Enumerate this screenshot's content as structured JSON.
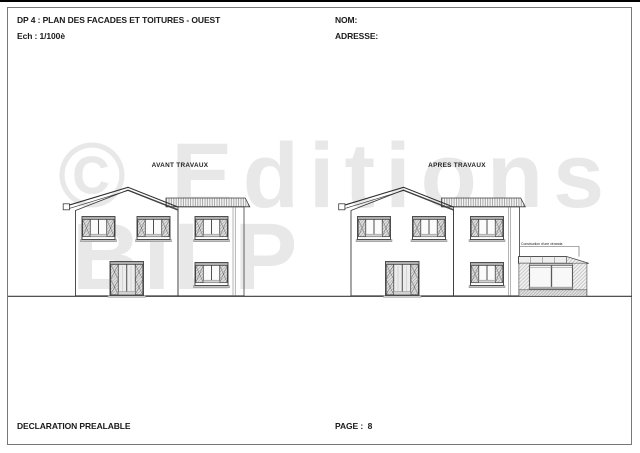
{
  "page": {
    "header": {
      "title": "DP 4 : PLAN DES FACADES ET TOITURES - OUEST",
      "scale": "Ech : 1/100è",
      "nom_label": "NOM:",
      "adresse_label": "ADRESSE:"
    },
    "footer": {
      "doc_type": "DECLARATION PREALABLE",
      "page_label": "PAGE :  8"
    },
    "watermark": {
      "line1": "© Editions",
      "line2": "BILP",
      "color": "#e8e8e8"
    }
  },
  "drawings": {
    "avant": {
      "caption": "AVANT TRAVAUX"
    },
    "apres": {
      "caption": "APRES TRAVAUX",
      "annotation": "Construction d'une véranda"
    }
  },
  "colors": {
    "line_work": "#3c3c3c",
    "border": "#787878",
    "ground_line": "#3a3a3a"
  }
}
